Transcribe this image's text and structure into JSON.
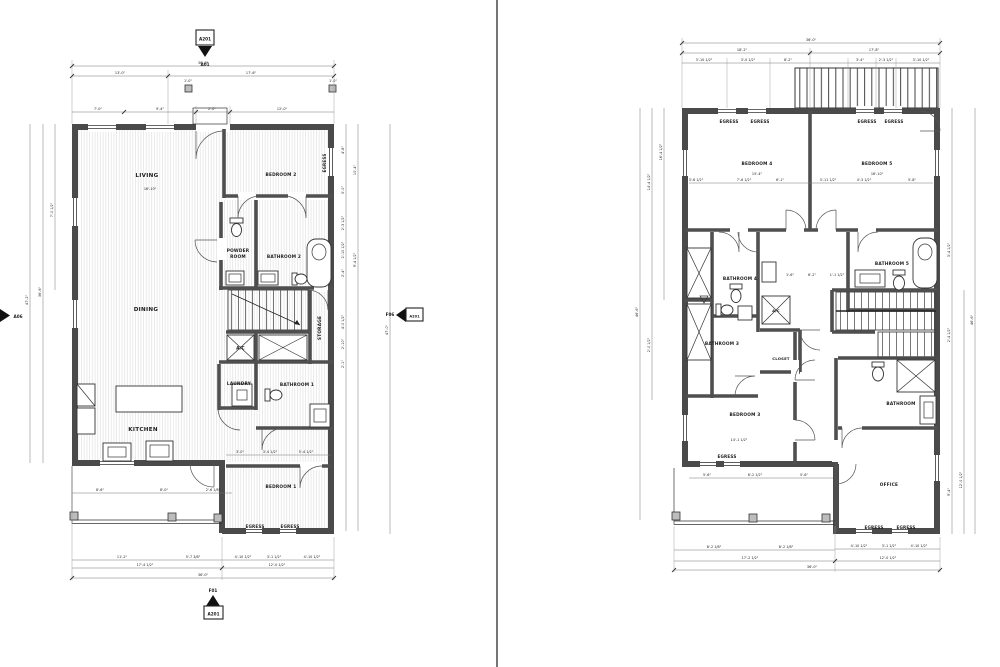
{
  "left_plan": {
    "markers": {
      "top": {
        "bubble": "A201",
        "ref": "A01"
      },
      "bottom": {
        "ref": "F01",
        "bubble": "A201"
      },
      "left": {
        "ref": "A06"
      },
      "right": {
        "ref": "F06",
        "bubble": "A201"
      }
    },
    "rooms": {
      "living": "LIVING",
      "bedroom2": "BEDROOM 2",
      "powder_line1": "POWDER",
      "powder_line2": "ROOM",
      "bathroom2": "BATHROOM 2",
      "dining": "DINING",
      "storage": "STORAGE",
      "ac": "A/C",
      "laundry": "LAUNDRY",
      "bathroom1": "BATHROOM 1",
      "kitchen": "KITCHEN",
      "bedroom1": "BEDROOM 1"
    },
    "egress": "EGRESS",
    "dims": {
      "overall_top": "36'-0\"",
      "top2": [
        "13'-0\"",
        "17'-6\""
      ],
      "top3": [
        "7'-0\"",
        "9'-4\"",
        "2'-0\"",
        "12'-0\""
      ],
      "post": "1'-0\"",
      "living_width": "16'-10\"",
      "porch": [
        "8'-6\"",
        "8'-0\"",
        "2'-6 1/8\""
      ],
      "bed1_interior": [
        "3'-0\"",
        "3'-4 1/2\"",
        "5'-4 1/2\""
      ],
      "bottom1": [
        "11'-2\"",
        "5'-7 3/8\"",
        "4'-10 1/2\"",
        "3'-1 1/2\"",
        "4'-10 1/2\""
      ],
      "bottom2": [
        "17'-4 1/2\"",
        "12'-0 1/2\""
      ],
      "overall_bottom": "36'-0\"",
      "left_col": [
        "47'-2\"",
        "36'-6\"",
        "7'-0 1/2\""
      ],
      "right_col1": [
        "4'-8\"",
        "5'-0\"",
        "2'-3 1/2\"",
        "2'-10 1/2\"",
        "2'-4\"",
        "4'-0 1/2\"",
        "2'-10\"",
        "2'-1\""
      ],
      "right_col2": [
        "10'-4\"",
        "9'-4 1/2\""
      ],
      "overall_right": "47'-0\""
    }
  },
  "right_plan": {
    "rooms": {
      "bedroom4": "BEDROOM 4",
      "bedroom5": "BEDROOM 5",
      "bathroom4": "BATHROOM 4",
      "bathroom5": "BATHROOM 5",
      "bathroom3": "BATHROOM 3",
      "closet": "CLOSET",
      "bedroom3": "BEDROOM 3",
      "bathroom": "BATHROOM",
      "office": "OFFICE"
    },
    "egress": "EGRESS",
    "dims": {
      "overall_top": "36'-0\"",
      "top2": [
        "18'-2\"",
        "17'-8\""
      ],
      "top3": [
        "3'-10 1/2\"",
        "3'-0 1/2\"",
        "8'-2\"",
        "3'-4\"",
        "2'-3 1/2\"",
        "3'-10 1/2\""
      ],
      "bed4_width": "15'-4\"",
      "bed5_width": "16'-10\"",
      "bed_row": [
        "3'-6 1/2\"",
        "7'-6 1/2\"",
        "6'-1\"",
        "3'-11 1/2\"",
        "4'-3 1/2\"",
        "5'-8\""
      ],
      "bath_row": [
        "1'-6\"",
        "6'-2\"",
        "1'-1 1/2\""
      ],
      "bed3_width": "14'-1 1/2\"",
      "bed3_row": [
        "5'-6\"",
        "6'-2 1/2\"",
        "5'-6\""
      ],
      "office_row": [
        "4'-10 1/2\"",
        "3'-1 1/2\"",
        "4'-10 1/2\""
      ],
      "office_total": "12'-0 1/2\"",
      "porch_row": [
        "8'-2 1/8\"",
        "8'-2 1/8\""
      ],
      "porch_total": "17'-2 1/2\"",
      "overall_bottom": "36'-0\"",
      "left_col": [
        "16'-4 1/2\"",
        "14'-4 1/2\"",
        "46'-6\"",
        "2'-0 1/2\""
      ],
      "right_col": [
        "3'-4 1/2\"",
        "2'-4 1/2\"",
        "12'-0 1/2\"",
        "9'-4\""
      ]
    }
  }
}
